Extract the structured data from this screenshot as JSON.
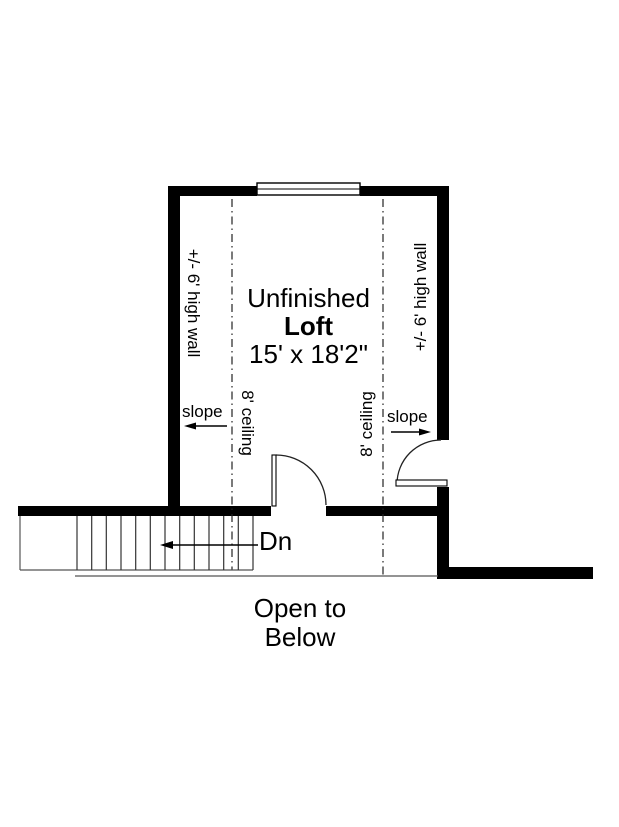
{
  "title": {
    "line1": "Unfinished",
    "line2": "Loft",
    "dimensions": "15' x 18'2\""
  },
  "labels": {
    "wall_height_left": "+/- 6' high wall",
    "wall_height_right": "+/- 6' high wall",
    "ceiling_left": "8' ceiling",
    "ceiling_right": "8' ceiling",
    "slope_left": "slope",
    "slope_right": "slope",
    "stairs_direction": "Dn",
    "open_below_line1": "Open to",
    "open_below_line2": "Below"
  },
  "colors": {
    "wall": "#000000",
    "thin_line": "#555555",
    "tread_line": "#333333",
    "text": "#000000",
    "background": "#ffffff"
  }
}
